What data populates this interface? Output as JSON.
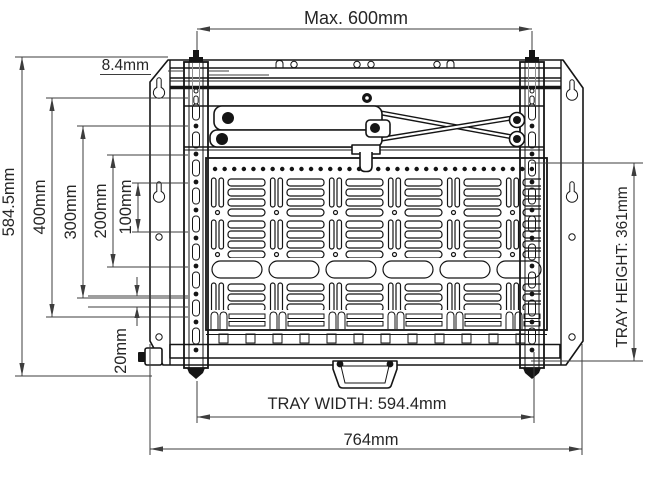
{
  "drawing": {
    "dim_max_width": "Max. 600mm",
    "dim_top_offset": "8.4mm",
    "dim_overall_height": "584.5mm",
    "dim_400": "400mm",
    "dim_300": "300mm",
    "dim_200": "200mm",
    "dim_100": "100mm",
    "dim_20": "20mm",
    "dim_tray_height": "TRAY HEIGHT: 361mm",
    "dim_tray_width": "TRAY WIDTH: 594.4mm",
    "dim_overall_width": "764mm"
  }
}
